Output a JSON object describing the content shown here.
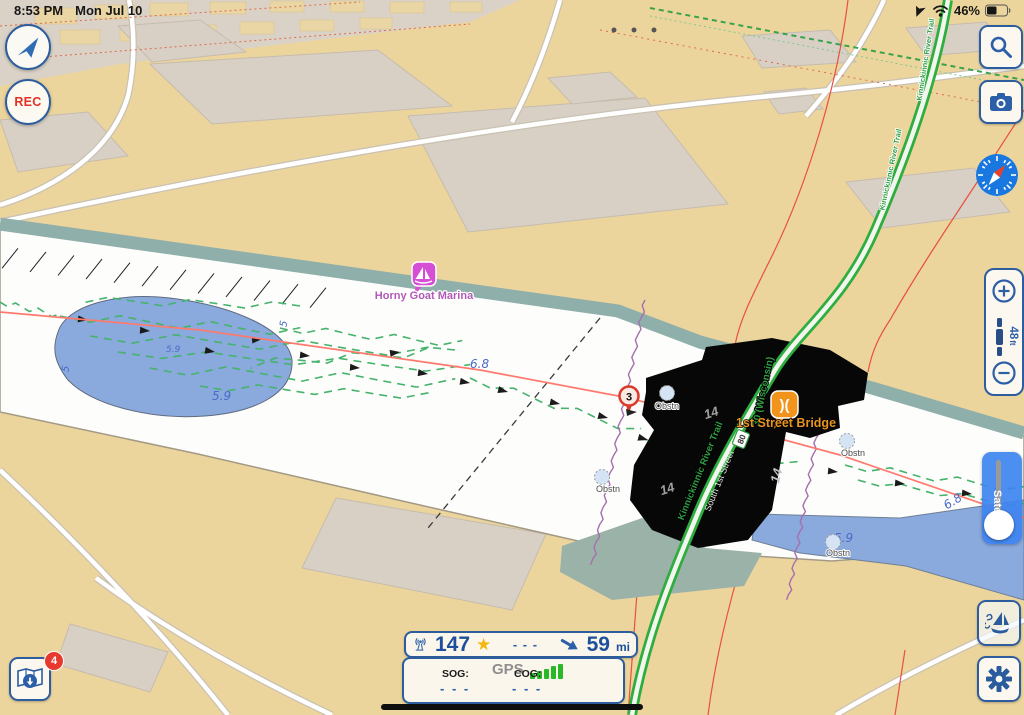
{
  "status_bar": {
    "time": "8:53 PM",
    "date": "Mon Jul 10",
    "battery_percent": "46%"
  },
  "left_controls": {
    "rec_label": "REC"
  },
  "right_controls": {
    "scale_value": "48",
    "scale_unit": "ft",
    "satellite_label": "Satellite"
  },
  "bottom_left": {
    "downloads_badge": "4"
  },
  "station_bar": {
    "heading": "147",
    "value_dashes": "- - -",
    "distance": "59",
    "distance_unit": "mi"
  },
  "gps_panel": {
    "title": "GPS",
    "sog_label": "SOG:",
    "sog_value": "- - -",
    "cog_label": "COG:",
    "cog_value": "- - -"
  },
  "map": {
    "marina_label": "Horny Goat Marina",
    "bridge_label": "1st Street Bridge",
    "road_shield": "30 (Wisconsin)",
    "trail_label": "Kinnickinnic River Trail",
    "street_label": "South 1st Street",
    "route_badge": "80",
    "waypoint_number": "3",
    "obstruction_label": "Obstn",
    "depths": {
      "channel": "6.8",
      "pond_a": "5.9",
      "pond_b": "5",
      "pond_c": "5.9",
      "pond_d": "5",
      "bridge_a": "14",
      "bridge_b": "14",
      "bridge_c": "14",
      "east_a": "6.8",
      "east_b": "5.9"
    }
  },
  "colors": {
    "ui_blue": "#2e5d9e",
    "rec_red": "#e03226",
    "land_tan": "#ecd59d",
    "shore_teal": "#8fafaa",
    "shallow_blue": "#8aa9dd",
    "track_green": "#45b36b",
    "route_red": "#ff7a6e",
    "depth_blue": "#4a6cc8",
    "marina_magenta": "#c94fc9",
    "bridge_orange": "#f2941c",
    "satellite_blue": "#3e84f0",
    "gps_green": "#28b828"
  }
}
